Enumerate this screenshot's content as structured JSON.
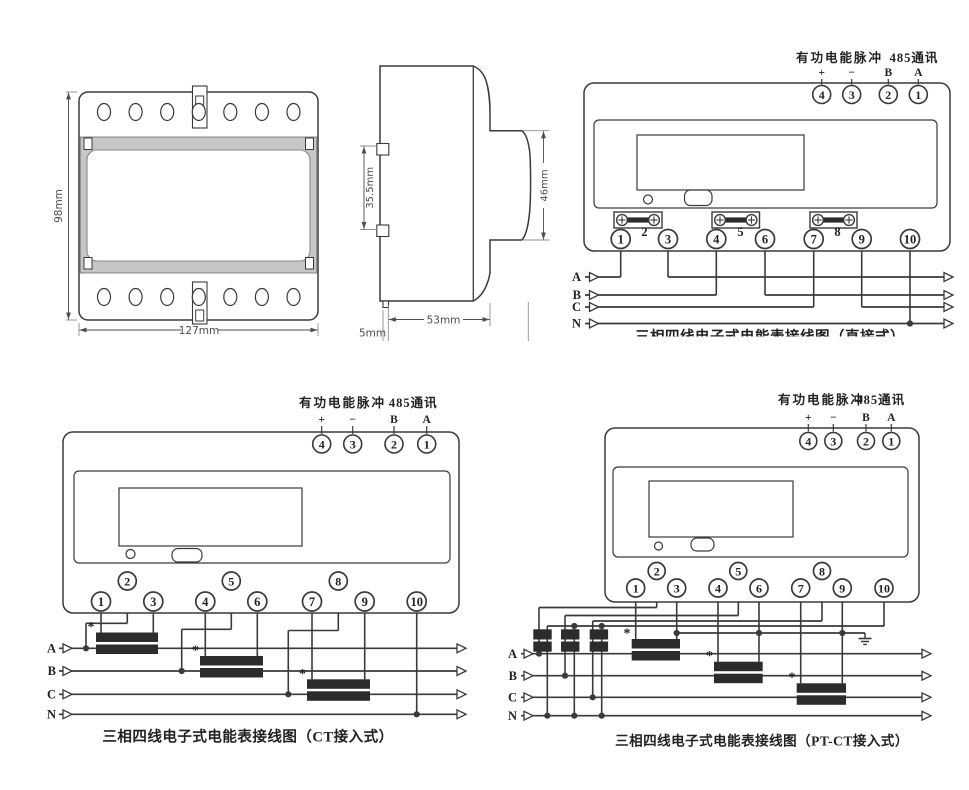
{
  "colors": {
    "line": "#3a3a3a",
    "bar": "#2c2c2c",
    "band": "#c6c6c6",
    "band_stroke": "#7a7a7a",
    "dim": "#8f8f8f",
    "dim_text": "#4d4d4d"
  },
  "front_view": {
    "height_dim": "98mm",
    "width_dim": "127mm"
  },
  "side_view": {
    "rail_dim": "35.5mm",
    "right_dim": "46mm",
    "depth_dim": "53mm",
    "foot_dim": "5mm"
  },
  "wiring": {
    "pulse_label": "有功电能脉冲",
    "comm_label": "485通讯",
    "top_signs": [
      "+",
      "−",
      "B",
      "A"
    ],
    "top_terminals": [
      "4",
      "3",
      "2",
      "1"
    ],
    "bottom_terminals": [
      "1",
      "2",
      "3",
      "4",
      "5",
      "6",
      "7",
      "8",
      "9",
      "10"
    ],
    "phases": [
      "A",
      "B",
      "C",
      "N"
    ],
    "ct_polarity_mark": "*",
    "captions": {
      "direct": "三相四线电子式电能表接线图（直接式）",
      "ct": "三相四线电子式电能表接线图（CT接入式）",
      "ptct": "三相四线电子式电能表接线图（PT-CT接入式）"
    }
  }
}
